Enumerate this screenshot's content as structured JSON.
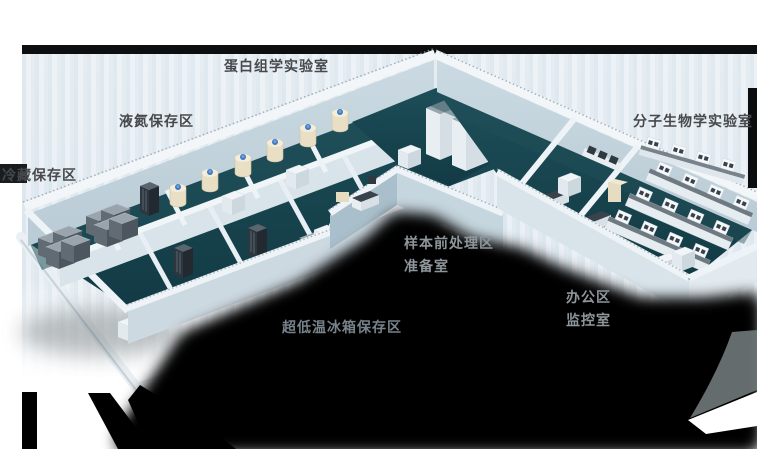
{
  "floorplan": {
    "title_context": "laboratory-3d-floorplan",
    "labels": [
      {
        "text": "蛋白组学实验室",
        "area": "proteomics-lab",
        "tone": "dark"
      },
      {
        "text": "液氮保存区",
        "area": "liquid-nitrogen-storage",
        "tone": "dark"
      },
      {
        "text": "冷藏保存区",
        "area": "cold-storage",
        "tone": "dark"
      },
      {
        "text": "分子生物学实验室",
        "area": "molecular-biology-lab",
        "tone": "dark"
      },
      {
        "text": "样本前处理区",
        "area": "sample-pretreatment",
        "tone": "light"
      },
      {
        "text": "准备室",
        "area": "preparation-room",
        "tone": "light"
      },
      {
        "text": "办公区",
        "area": "office-area",
        "tone": "light"
      },
      {
        "text": "监控室",
        "area": "monitoring-room",
        "tone": "light"
      },
      {
        "text": "超低温冰箱保存区",
        "area": "ult-freezer-storage",
        "tone": "dim"
      }
    ],
    "colors": {
      "floor_teal": "#17434d",
      "wall_white": "#eef3f7",
      "wall_shade": "#c5d5de",
      "backdrop_stripe": "#e4ecf1",
      "top_bar": "#0d0e10",
      "shadow": "#000000",
      "dewar_body": "#e8dfc4",
      "dewar_cap": "#3d7ac6",
      "freezer_top": "#99a4ac",
      "freezer_side": "#616b74",
      "label_dark": "#47494c",
      "label_light": "#8e969b"
    }
  }
}
